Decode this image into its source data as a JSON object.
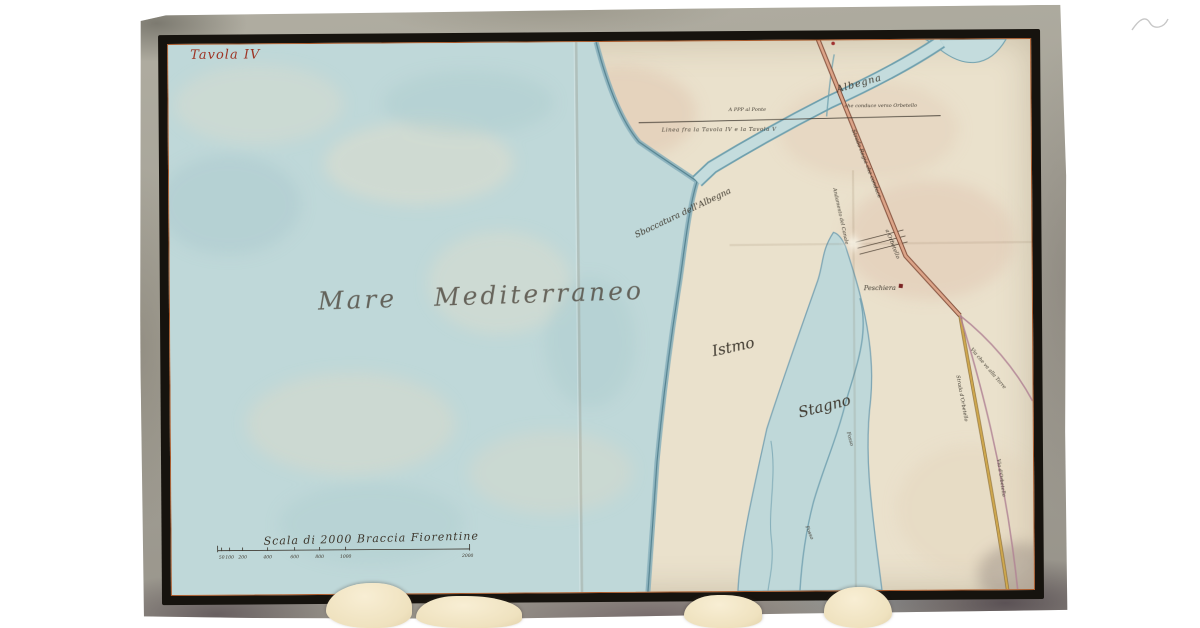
{
  "map": {
    "plate_title": "Tavola IV",
    "sea_label": "Mare Mediterraneo",
    "region_labels": {
      "istmo": "Istmo",
      "stagno": "Stagno"
    },
    "water_labels": {
      "albegna": "Albegna",
      "river_mouth": "Sboccatura dell'Albegna",
      "fosso_1": "Fosso",
      "fosso_2": "Fosso"
    },
    "place_labels": {
      "peschiera": "Peschiera"
    },
    "boundary": {
      "line_label": "Linea fra la Tavola IV e la Tavola V",
      "note_left": "A PPP al Ponte",
      "note_right": "che conduce verso Orbetello"
    },
    "road_labels": {
      "strada_regia_1": "Strada Regia che conduce",
      "strada_regia_2": "a Orbetello",
      "andamento": "Andamento del Canale",
      "via_torre": "Via che va alla Torre",
      "strada_orbetello": "Strada d'Orbetello",
      "via_orbetello": "Via d'Orbetello"
    },
    "scale": {
      "label": "Scala di 2000 Braccia Fiorentine",
      "ticks": [
        "50",
        "100",
        "200",
        "400",
        "600",
        "800",
        "1000",
        "2000"
      ]
    },
    "colors": {
      "paper": "#eae1cc",
      "sea": "#bfd8d9",
      "coast_edge": "#6f9fae",
      "frame": "#16130e",
      "margin": "#a4a196",
      "inner_rule": "#a8582a",
      "title_ink": "#9e3424",
      "ink": "#3e382e",
      "road_red": "#a05a40",
      "road_yellow": "#c9a54b",
      "road_pink": "#b08294"
    }
  }
}
